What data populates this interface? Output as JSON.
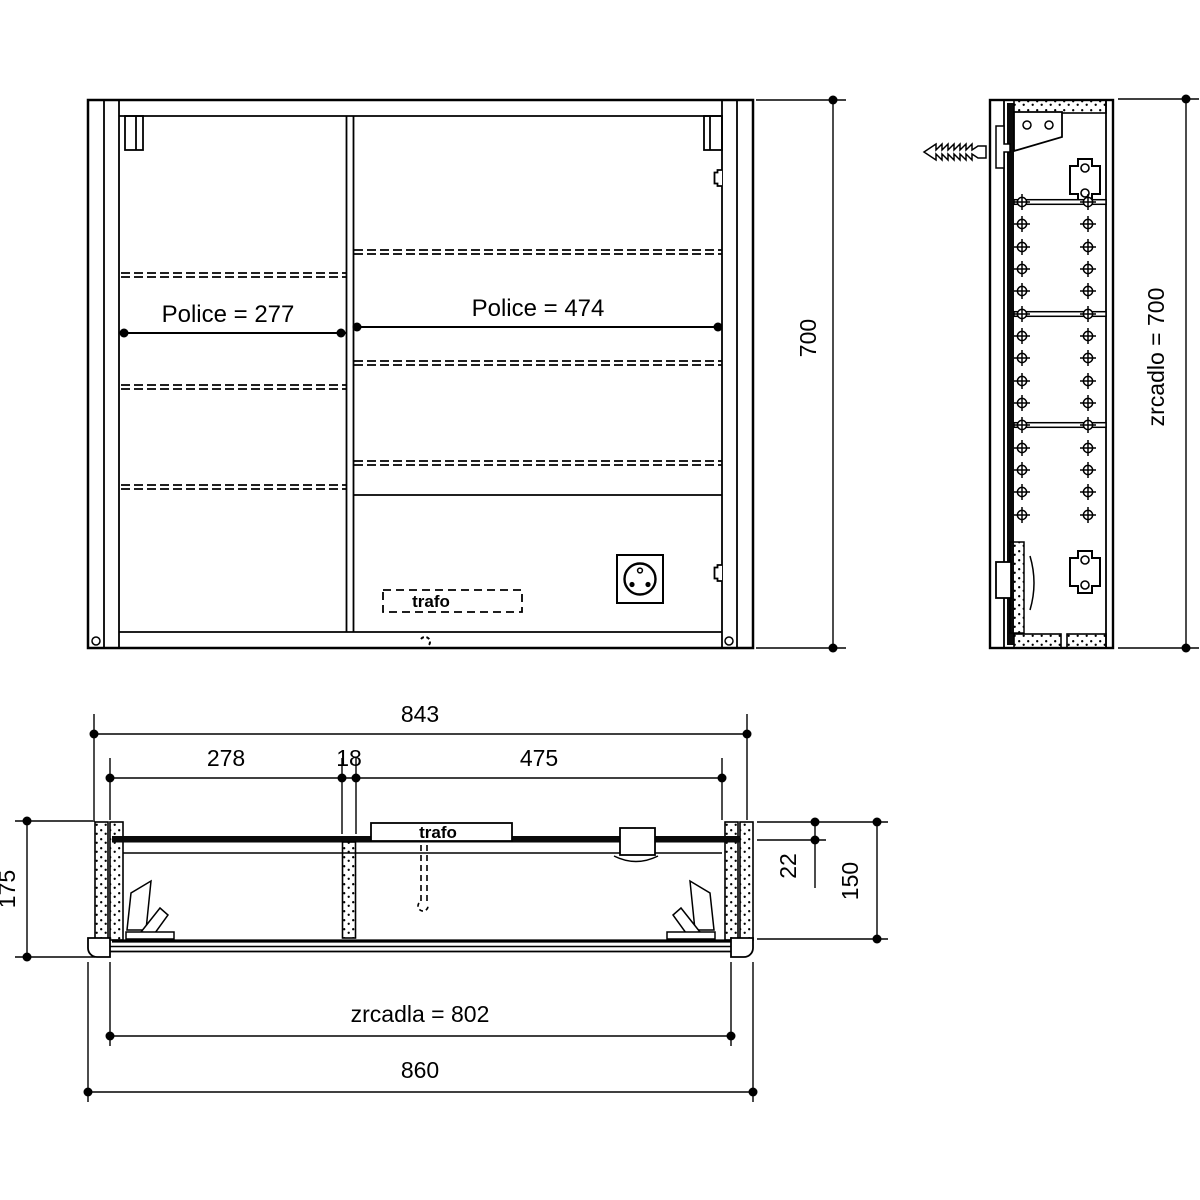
{
  "drawing_type": "furniture technical drawing - mirror cabinet",
  "colors": {
    "line": "#000000",
    "background": "#ffffff"
  },
  "views": {
    "front": {
      "shelf_left": "Police = 277",
      "shelf_right": "Police = 474",
      "trafo": "trafo",
      "dim_height": "700"
    },
    "side": {
      "dim_mirror_height": "zrcadlo = 700"
    },
    "plan": {
      "dim_carcass_width": "843",
      "dim_left_compartment": "278",
      "dim_divider": "18",
      "dim_right_compartment": "475",
      "dim_depth_total": "175",
      "dim_back_offset": "22",
      "dim_depth_body": "150",
      "dim_mirror_width": "zrcadla = 802",
      "dim_overall_width": "860",
      "trafo": "trafo"
    }
  }
}
